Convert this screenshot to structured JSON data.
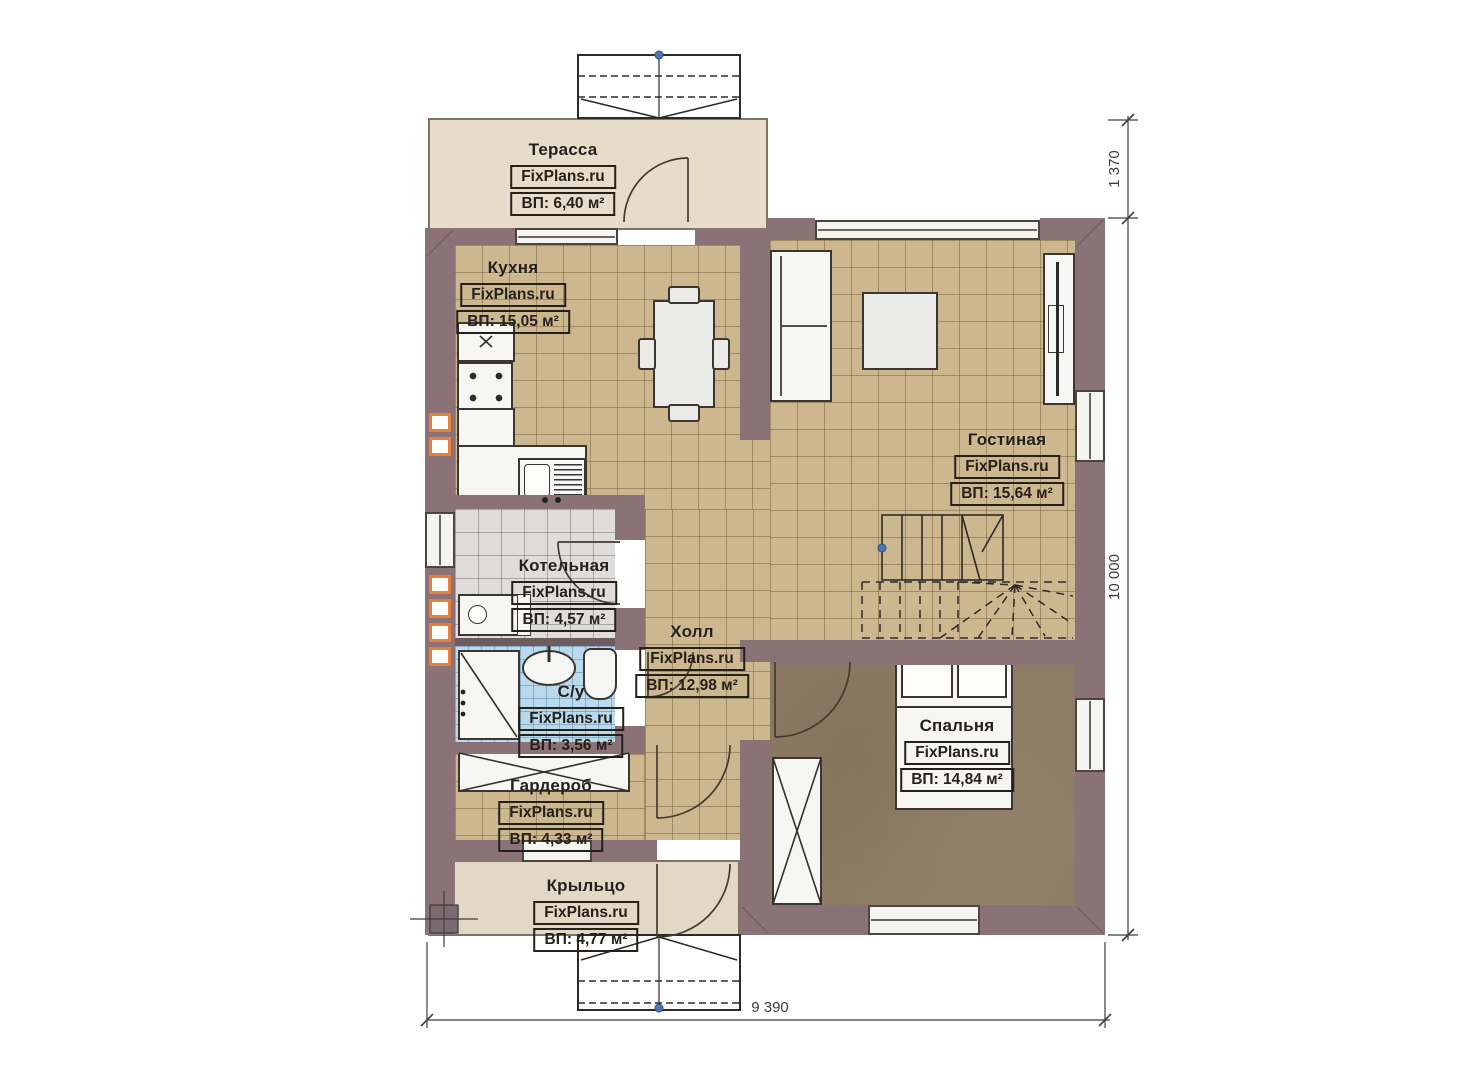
{
  "rooms": {
    "terrace": {
      "name": "Терасса",
      "site": "FixPlans.ru",
      "area": "ВП: 6,40 м²"
    },
    "kitchen": {
      "name": "Кухня",
      "site": "FixPlans.ru",
      "area": "ВП: 15,05 м²"
    },
    "living": {
      "name": "Гостиная",
      "site": "FixPlans.ru",
      "area": "ВП: 15,64 м²"
    },
    "boiler": {
      "name": "Котельная",
      "site": "FixPlans.ru",
      "area": "ВП: 4,57 м²"
    },
    "hall": {
      "name": "Холл",
      "site": "FixPlans.ru",
      "area": "ВП: 12,98 м²"
    },
    "bathroom": {
      "name": "С/у",
      "site": "FixPlans.ru",
      "area": "ВП: 3,56 м²"
    },
    "bedroom": {
      "name": "Спальня",
      "site": "FixPlans.ru",
      "area": "ВП: 14,84 м²"
    },
    "wardrobe": {
      "name": "Гардероб",
      "site": "FixPlans.ru",
      "area": "ВП: 4,33 м²"
    },
    "porch": {
      "name": "Крыльцо",
      "site": "FixPlans.ru",
      "area": "ВП: 4,77 м²"
    }
  },
  "dimensions": {
    "terrace_depth": "1 370",
    "house_height": "10 000",
    "house_width": "9 390"
  },
  "colors": {
    "wall": "#8b7276",
    "tile_floor": "#cdb78f",
    "bedroom_floor": "#8d7b63",
    "bathroom_floor": "#b9d9ed",
    "boiler_floor": "#dedddb",
    "terrace_floor": "#e6dcc9",
    "porch_floor": "#e2d8c5",
    "vent_accent": "#e8803c",
    "reference_point": "#4a7ab5"
  }
}
